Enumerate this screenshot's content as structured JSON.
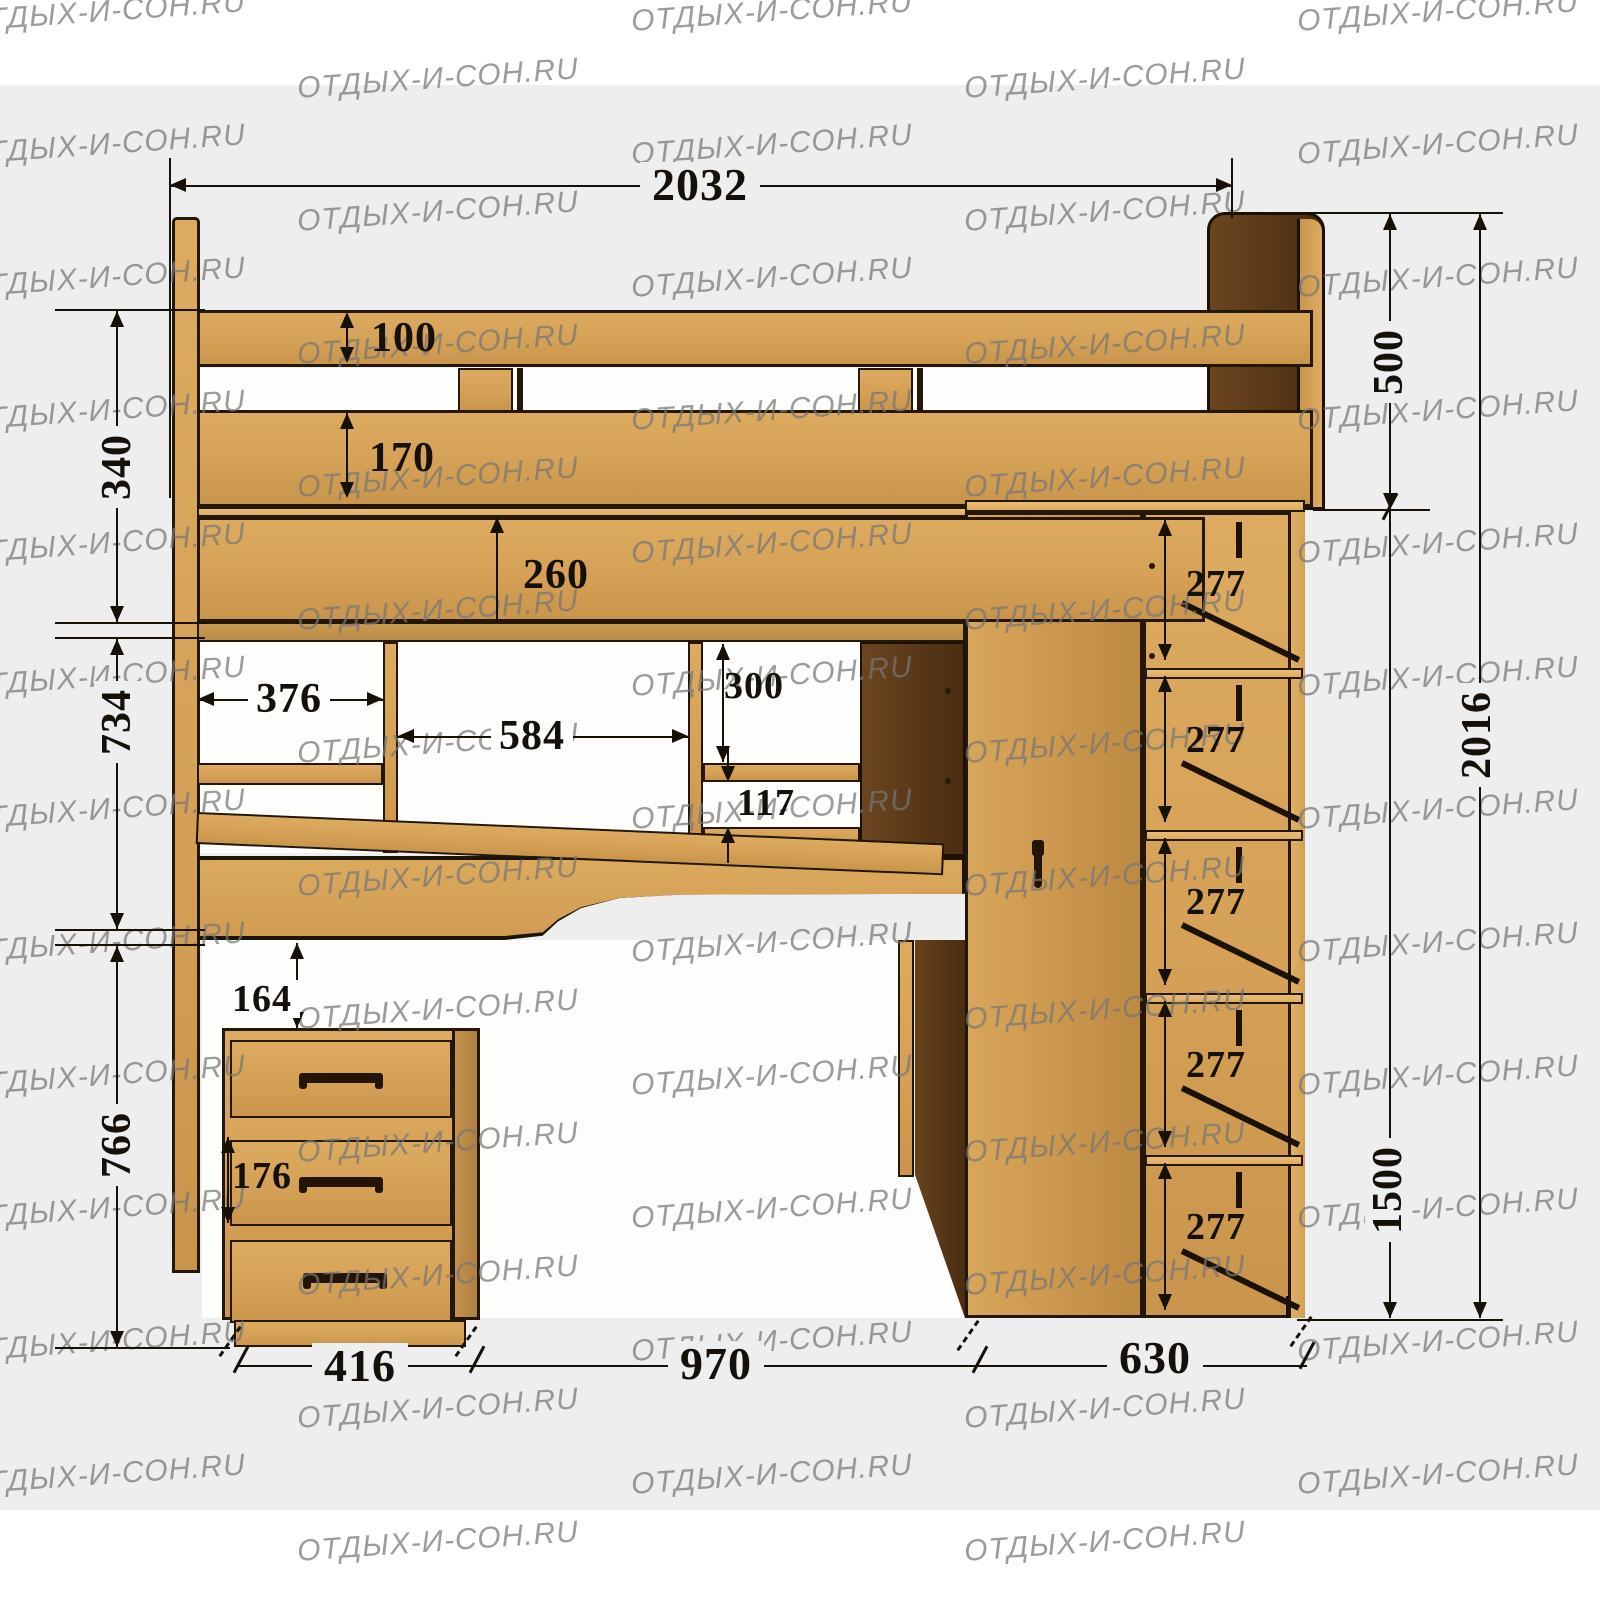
{
  "watermark": {
    "text": "ОТДЫХ-И-СОН.RU"
  },
  "dims": {
    "overall_width": "2032",
    "guard_top": "100",
    "guard_bottom": "170",
    "guard_total": "340",
    "bed_fascia": "260",
    "headboard_above": "500",
    "cubby_left_width": "376",
    "cubby_mid_width": "584",
    "cubby_right_height": "300",
    "cubby_gap": "117",
    "hutch_height": "734",
    "desk_gap": "164",
    "drawer_height": "176",
    "under_desk_height": "766",
    "drawer_unit_width": "416",
    "desk_opening_width": "970",
    "wardrobe_depth": "630",
    "wardrobe_height": "1500",
    "total_height": "2016",
    "shelf_gaps": [
      "277",
      "277",
      "277",
      "277",
      "277"
    ]
  }
}
